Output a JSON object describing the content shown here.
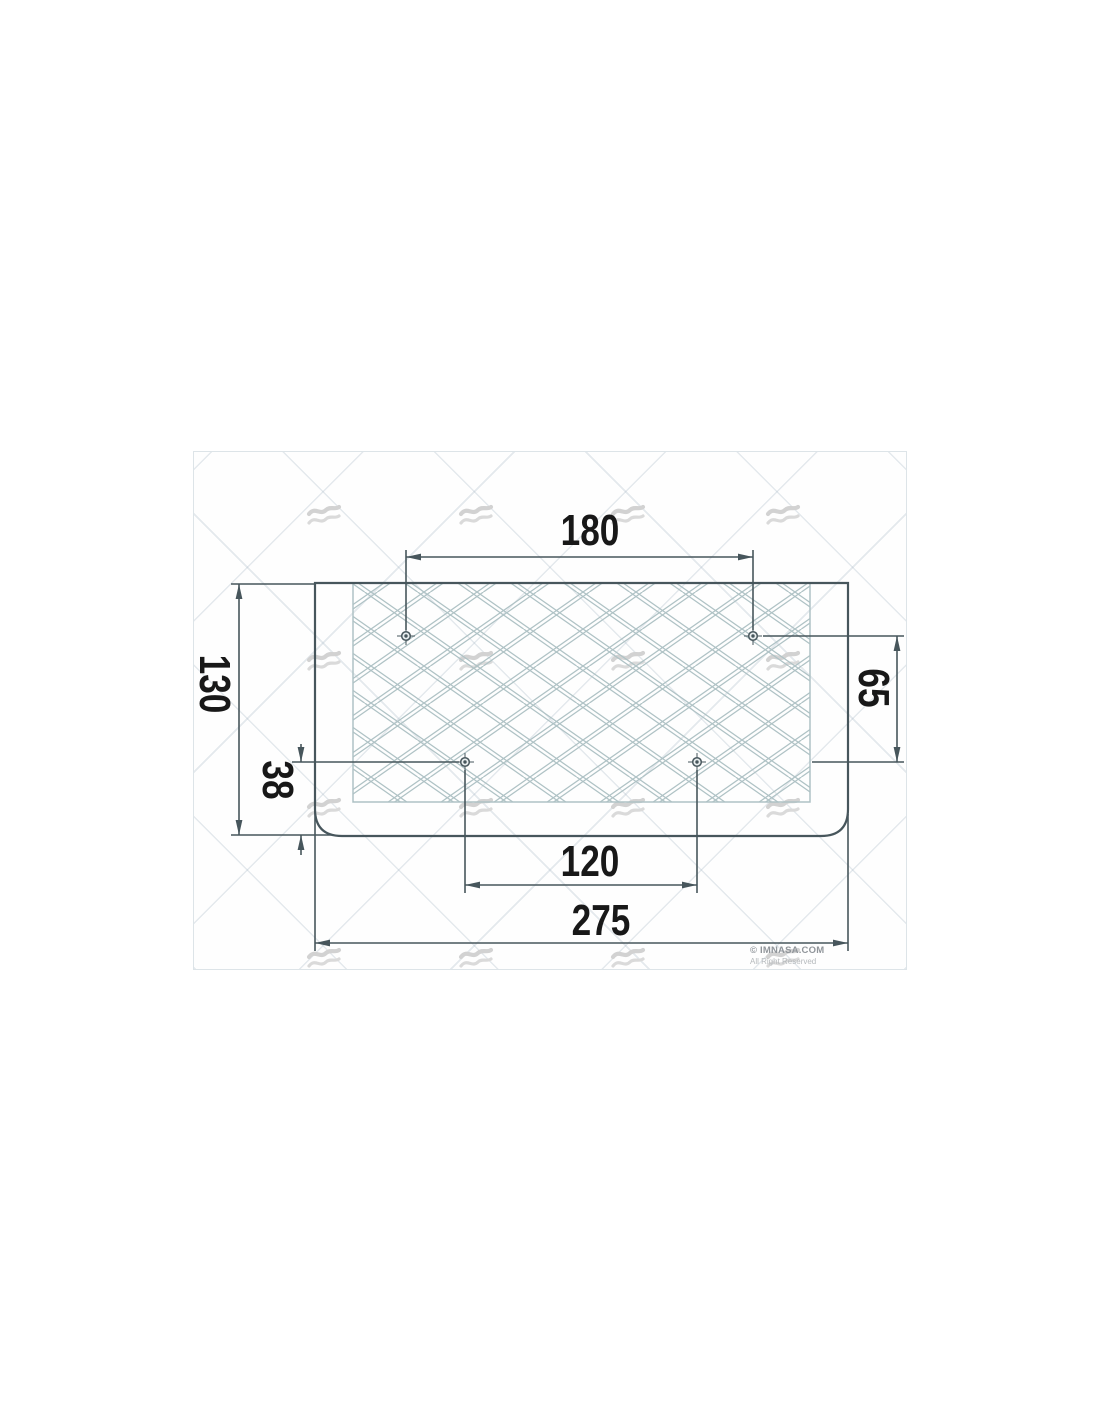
{
  "diagram": {
    "dimensions": {
      "top_hole_spacing_mm": "180",
      "overall_height_mm": "130",
      "right_hole_vertical_offset_mm": "65",
      "bottom_hole_to_edge_mm": "38",
      "bottom_hole_spacing_mm": "120",
      "overall_width_mm": "275"
    },
    "copyright": {
      "line1": "© IMNASA.COM",
      "line2": "All Right Reserved"
    },
    "icons": {
      "watermark": "wave-icon",
      "hole_symbol": "crosshair-target"
    },
    "colors": {
      "drawing_line": "#47565c",
      "mesh_line": "#afc2c5",
      "label_text": "#181818",
      "watermark": "#d4d4d4"
    }
  }
}
